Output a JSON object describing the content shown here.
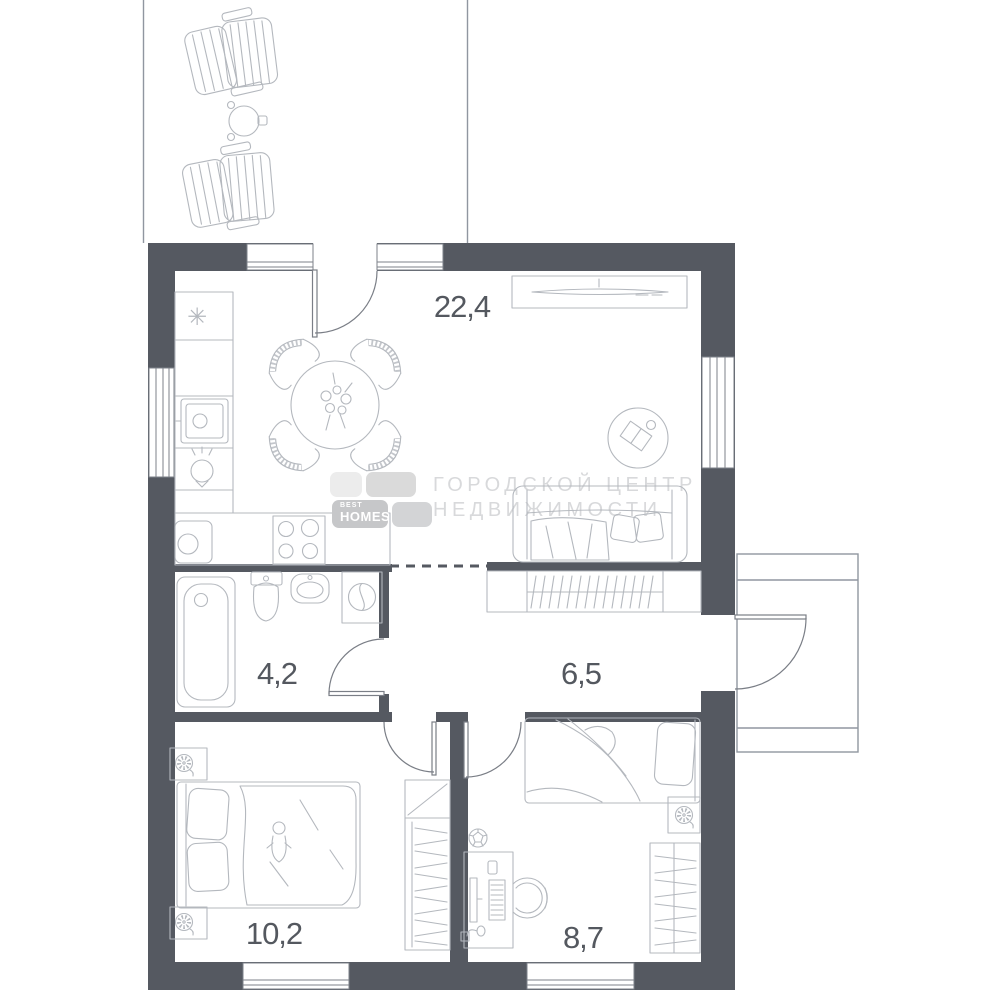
{
  "plan": {
    "type": "apartment floor plan"
  },
  "rooms": [
    {
      "id": "kitchen-living-room",
      "area": "22,4"
    },
    {
      "id": "bathroom",
      "area": "4,2"
    },
    {
      "id": "hallway",
      "area": "6,5"
    },
    {
      "id": "bedroom-1",
      "area": "10,2"
    },
    {
      "id": "bedroom-2",
      "area": "8,7"
    }
  ],
  "watermark": {
    "brand_top": "BEST",
    "brand_bottom": "HOMES",
    "line1": "ГОРОДСКОЙ ЦЕНТР",
    "line2": "НЕДВИЖИМОСТИ"
  },
  "symbols": {
    "vent_star": "✳"
  },
  "colors": {
    "wall": "#555961",
    "furniture_line": "#b4b8be",
    "label": "#54585f",
    "watermark_text": "#d8d9db"
  }
}
